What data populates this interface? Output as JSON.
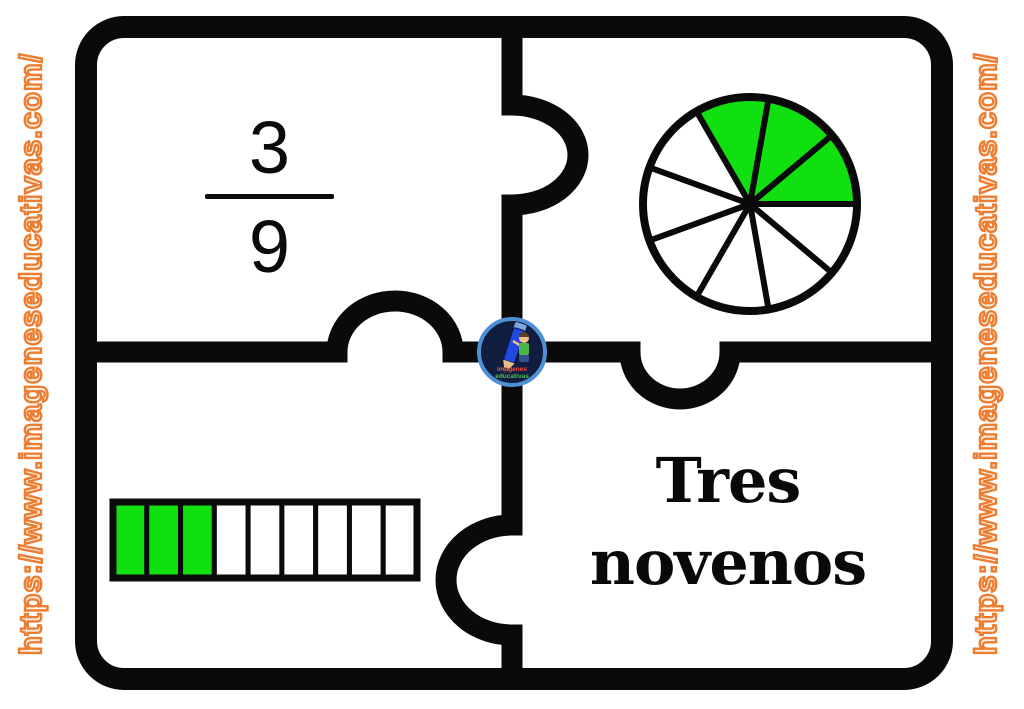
{
  "watermark": {
    "left_text": "https://www.imageneseducativas.com/",
    "right_text": "https://www.imageneseducativas.com/",
    "stroke_color": "#ed7d31"
  },
  "fraction_card": {
    "numerator": "3",
    "denominator": "9"
  },
  "pie_card": {
    "slices": 9,
    "shaded": 3,
    "start_angle_deg": 0,
    "shaded_color": "#10df10",
    "unshaded_color": "#ffffff"
  },
  "bar_card": {
    "segments": 9,
    "shaded": 3,
    "shaded_color": "#10df10",
    "unshaded_color": "#ffffff"
  },
  "label_card": {
    "line1": "Tres",
    "line2": "novenos"
  },
  "logo": {
    "line1": "imágenes",
    "line2": "educativas"
  },
  "colors": {
    "outline": "#0a0a0a",
    "green": "#10df10",
    "orange": "#ed7d31"
  },
  "chart_data": [
    {
      "type": "pie",
      "title": "Fracción representada con sectores",
      "slices": 9,
      "values": [
        1,
        1,
        1,
        1,
        1,
        1,
        1,
        1,
        1
      ],
      "shaded_slices": 3,
      "shaded_color": "#10df10",
      "unshaded_color": "#ffffff",
      "fraction": "3/9"
    },
    {
      "type": "bar",
      "title": "Fracción representada con barra segmentada",
      "segments": 9,
      "shaded_segments": 3,
      "shaded_color": "#10df10",
      "unshaded_color": "#ffffff",
      "fraction": "3/9"
    }
  ]
}
